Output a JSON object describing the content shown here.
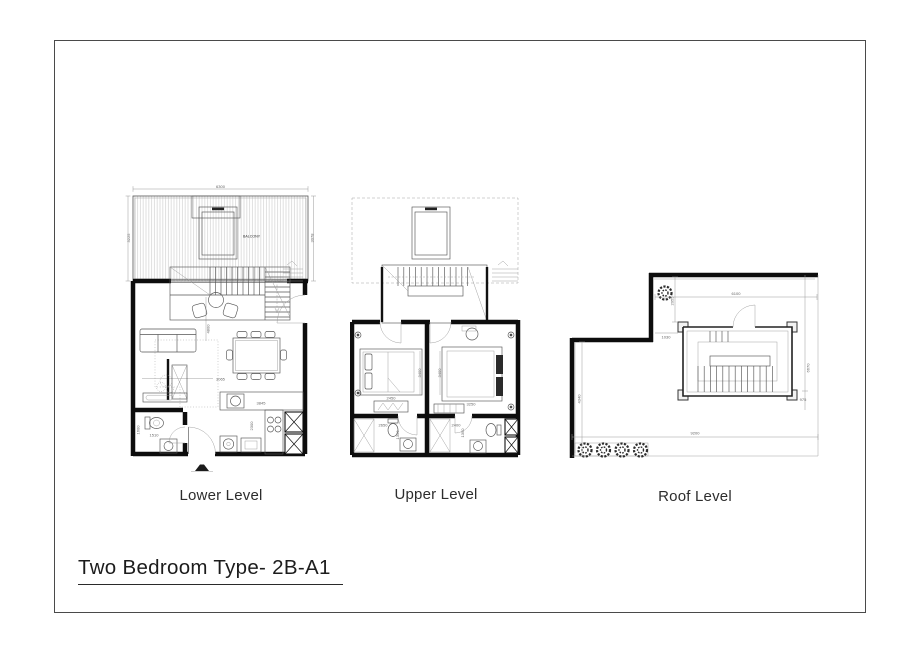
{
  "sheet": {
    "title": "Two Bedroom Type- 2B-A1"
  },
  "plans": [
    {
      "label": "Lower Level",
      "balcony_label": "BALCONY",
      "dims": {
        "top": "6300",
        "left": "3225",
        "right": "3078",
        "hall_height": "4800",
        "living_width": "3065",
        "counter": "3845",
        "kitchen_depth": "2300",
        "bath_width": "1510",
        "bath_depth": "1600"
      }
    },
    {
      "label": "Upper Level",
      "dims": {
        "bed1_width": "2450",
        "bed1_height": "3400",
        "bed2_width": "3250",
        "bed2_height": "3400",
        "bath1_width": "2650",
        "bath1_depth": "1350",
        "bath2_width": "2400",
        "bath2_depth": "1350"
      }
    },
    {
      "label": "Roof Level",
      "dims": {
        "top": "6100",
        "stair_offset": "2055",
        "wall_offset": "1030",
        "left": "4340",
        "bottom": "9200",
        "right": "6670",
        "right_lower": "975"
      }
    }
  ]
}
